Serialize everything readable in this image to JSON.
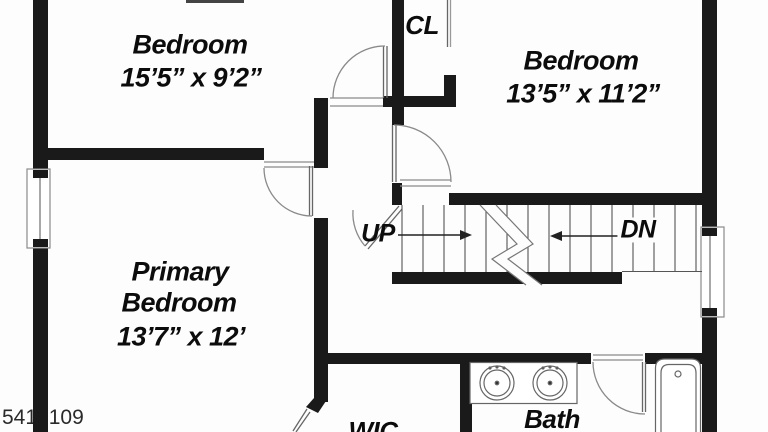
{
  "colors": {
    "wall": "#1a1a1a",
    "thin_line": "#777777",
    "background": "#fdfdfd",
    "text": "#0c0c0c",
    "watermark_text": "#2a2a2a"
  },
  "rooms": {
    "bedroom_top_left": {
      "name": "Bedroom",
      "dims": "15’5” x 9’2”"
    },
    "bedroom_top_right": {
      "name": "Bedroom",
      "dims": "13’5” x 11’2”"
    },
    "primary_bedroom": {
      "name_line1": "Primary",
      "name_line2": "Bedroom",
      "dims": "13’7” x 12’"
    },
    "closet": {
      "label": "CL"
    },
    "walk_in_closet": {
      "label": "WIC"
    },
    "bathroom": {
      "label": "Bath"
    }
  },
  "stairs": {
    "up": "UP",
    "down": "DN"
  },
  "watermark": {
    "listing_number": "5417109"
  }
}
